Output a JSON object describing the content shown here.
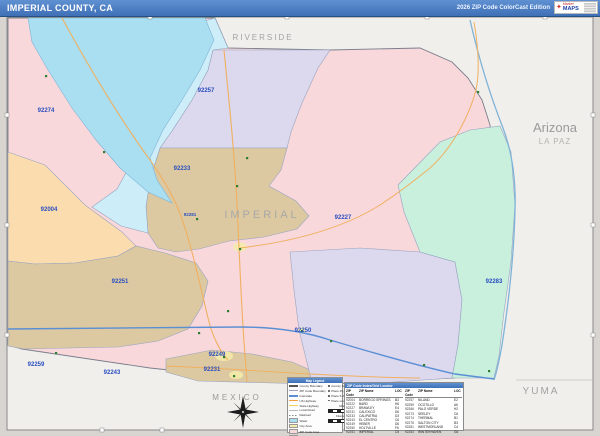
{
  "header": {
    "title": "IMPERIAL COUNTY, CA",
    "edition": "2026 ZIP Code ColorCast Edition",
    "logo_line1": "Market",
    "logo_line2": "MAPS"
  },
  "map": {
    "county_label": "IMPERIAL",
    "labels": {
      "north": "RIVERSIDE",
      "state": "Arizona",
      "east_county": "LA PAZ",
      "southeast_county": "YUMA",
      "south_country": "MEXICO"
    },
    "zips": [
      "92274",
      "92257",
      "92233",
      "92281",
      "92004",
      "92251",
      "92227",
      "92283",
      "92250",
      "92259",
      "92243",
      "92249",
      "92231"
    ],
    "colors": {
      "pink": "#f9d8db",
      "orange": "#fbdcae",
      "tan": "#dcc9a1",
      "lavender": "#dcd8ee",
      "mint": "#c9efdd",
      "sea": "#a9dff1",
      "pale_cyan": "#cdeef8",
      "road_orange": "#f0b060",
      "interstate_blue": "#5b8fd4",
      "boundary": "#97a4c0",
      "zip_label": "#2a4fc0"
    }
  },
  "legend": {
    "title": "Map Legend",
    "lines": [
      "County Boundary",
      "ZIP Code Boundary",
      "Interstate",
      "US Highway",
      "State Highway",
      "Local Road",
      "Railroad",
      "Water"
    ],
    "chips": [
      "City Area",
      "ZIP Code Area",
      "Water Body",
      "Indian Reserv."
    ],
    "places": [
      "County Seat",
      "Place 25,000+",
      "Place 5,000-25,000",
      "Place under 5,000"
    ],
    "scale_miles": "Miles",
    "scale_km": "Kilometers"
  },
  "index_table": {
    "title": "ZIP Code Index/Grid Locator",
    "col_zip": "ZIP Code",
    "col_name": "ZIP Name",
    "col_loc": "LOC",
    "rows_left": [
      [
        "92004",
        "BORREGO SPRINGS",
        "B3"
      ],
      [
        "92222",
        "BARD",
        "H6"
      ],
      [
        "92227",
        "BRAWLEY",
        "E4"
      ],
      [
        "92231",
        "CALEXICO",
        "D6"
      ],
      [
        "92233",
        "CALIPATRIA",
        "D3"
      ],
      [
        "92243",
        "EL CENTRO",
        "C6"
      ],
      [
        "92249",
        "HEBER",
        "D6"
      ],
      [
        "92250",
        "HOLTVILLE",
        "F6"
      ],
      [
        "92251",
        "IMPERIAL",
        "C5"
      ]
    ],
    "rows_right": [
      [
        "92257",
        "NILAND",
        "E2"
      ],
      [
        "92259",
        "OCOTILLO",
        "A6"
      ],
      [
        "92266",
        "PALO VERDE",
        "H2"
      ],
      [
        "92273",
        "SEELEY",
        "C6"
      ],
      [
        "92274",
        "THERMAL",
        "B1"
      ],
      [
        "92275",
        "SALTON CITY",
        "B3"
      ],
      [
        "92281",
        "WESTMORLAND",
        "C4"
      ],
      [
        "92283",
        "WINTERHAVEN",
        "G6"
      ]
    ]
  }
}
